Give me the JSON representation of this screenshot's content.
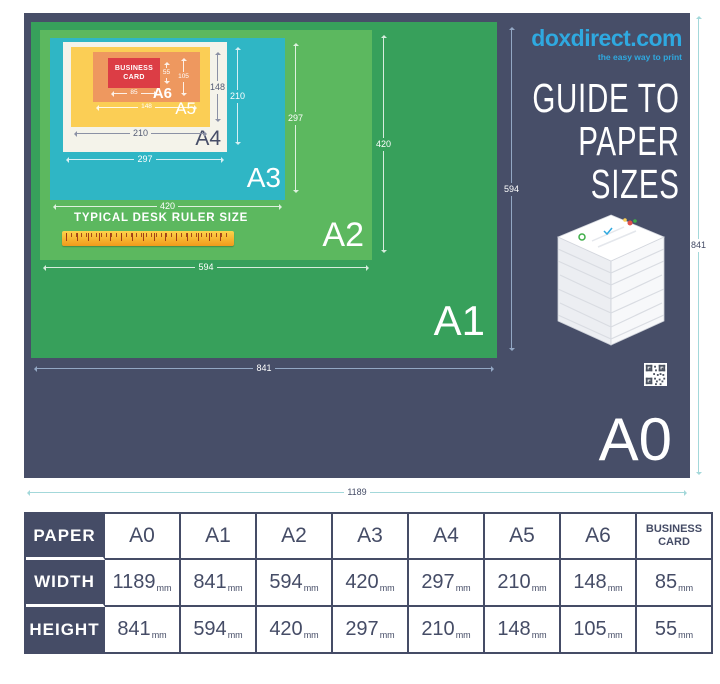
{
  "brand": {
    "name": "doxdirect.com",
    "tagline": "the easy way to print",
    "color": "#2fa9e0"
  },
  "title": {
    "lines": [
      "GUIDE TO",
      "PAPER",
      "SIZES"
    ]
  },
  "poster": {
    "labels": {
      "a0": "A0",
      "a1": "A1",
      "a2": "A2",
      "a3": "A3",
      "a4": "A4",
      "a5": "A5",
      "a6": "A6"
    },
    "business_card_label": "BUSINESS CARD",
    "ruler_caption": "TYPICAL DESK RULER SIZE",
    "dims": {
      "a0_w": "1189",
      "a0_h": "841",
      "a1_w": "841",
      "a1_h": "594",
      "a2_w": "594",
      "a2_h": "420",
      "a3_w": "420",
      "a3_h": "297",
      "a4_w": "297",
      "a4_h": "210",
      "a5_w": "210",
      "a5_h": "148",
      "a6_w": "148",
      "a6_h": "105",
      "bc_w": "85",
      "bc_h": "55"
    }
  },
  "colors": {
    "poster_navy": "#474e68",
    "a1_green": "#37a05b",
    "a2_green": "#5cb85f",
    "a3_teal": "#2fb6c5",
    "a4_offwhite": "#f4f3ea",
    "a5_yellow": "#fbce55",
    "a6_orange": "#ee985f",
    "business_card_red": "#dc3d45",
    "brand_blue": "#2fa9e0",
    "outer_dim_teal": "#a3d8da"
  },
  "table": {
    "unit": "mm",
    "row_headers": [
      "PAPER",
      "WIDTH",
      "HEIGHT"
    ],
    "columns": [
      "A0",
      "A1",
      "A2",
      "A3",
      "A4",
      "A5",
      "A6",
      "BUSINESS CARD"
    ],
    "rows": [
      {
        "header": "WIDTH",
        "values": [
          "1189",
          "841",
          "594",
          "420",
          "297",
          "210",
          "148",
          "85"
        ]
      },
      {
        "header": "HEIGHT",
        "values": [
          "841",
          "594",
          "420",
          "297",
          "210",
          "148",
          "105",
          "55"
        ]
      }
    ]
  }
}
